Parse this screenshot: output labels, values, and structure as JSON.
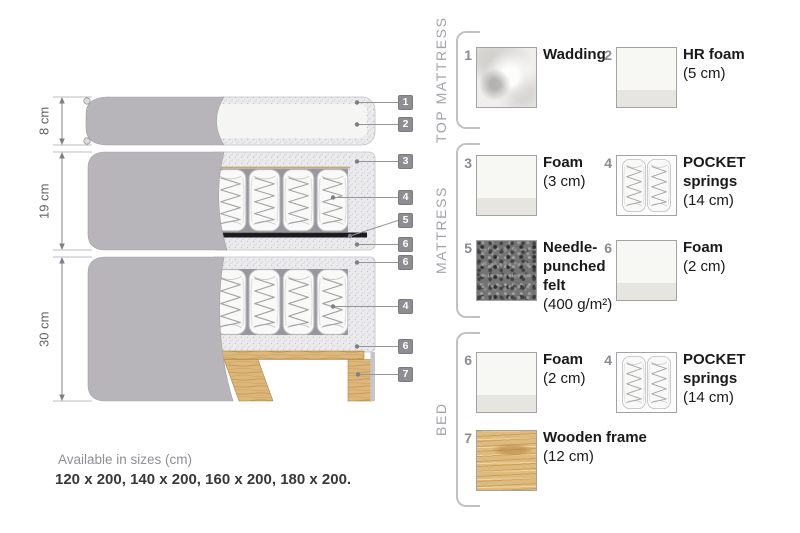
{
  "diagram": {
    "dimensions": [
      {
        "label": "8 cm"
      },
      {
        "label": "19 cm"
      },
      {
        "label": "30 cm"
      }
    ],
    "callouts": [
      "1",
      "2",
      "3",
      "4",
      "5",
      "6",
      "6",
      "4",
      "6",
      "7"
    ]
  },
  "legend": {
    "sections": [
      {
        "title": "TOP MATTRESS",
        "items": [
          {
            "num": "1",
            "name": "Wadding",
            "size": "",
            "swatch": "wadding"
          },
          {
            "num": "2",
            "name": "HR foam",
            "size": "(5 cm)",
            "swatch": "foam"
          }
        ]
      },
      {
        "title": "MATTRESS",
        "items": [
          {
            "num": "3",
            "name": "Foam",
            "size": "(3 cm)",
            "swatch": "foam"
          },
          {
            "num": "4",
            "name": "POCKET springs",
            "size": "(14 cm)",
            "swatch": "springs"
          },
          {
            "num": "5",
            "name": "Needle-punched felt",
            "size": "(400 g/m²)",
            "swatch": "felt"
          },
          {
            "num": "6",
            "name": "Foam",
            "size": "(2 cm)",
            "swatch": "foam"
          }
        ]
      },
      {
        "title": "BED",
        "items": [
          {
            "num": "6",
            "name": "Foam",
            "size": "(2 cm)",
            "swatch": "foam"
          },
          {
            "num": "4",
            "name": "POCKET springs",
            "size": "(14 cm)",
            "swatch": "springs"
          },
          {
            "num": "7",
            "name": "Wooden frame",
            "size": "(12 cm)",
            "swatch": "wood"
          }
        ]
      }
    ]
  },
  "footer": {
    "sizes_title": "Available in sizes (cm)",
    "sizes_list": "120 x 200, 140 x 200, 160 x 200, 180 x 200."
  },
  "colors": {
    "cover_gray": "#b7b5b9",
    "foam_speckle": "#ebebee",
    "felt_black": "#1c1c1e",
    "wood_tan": "#ddb77a",
    "badge_gray": "#8e8d93",
    "text_dark": "#1b191a",
    "text_gray": "#8b8a90"
  }
}
